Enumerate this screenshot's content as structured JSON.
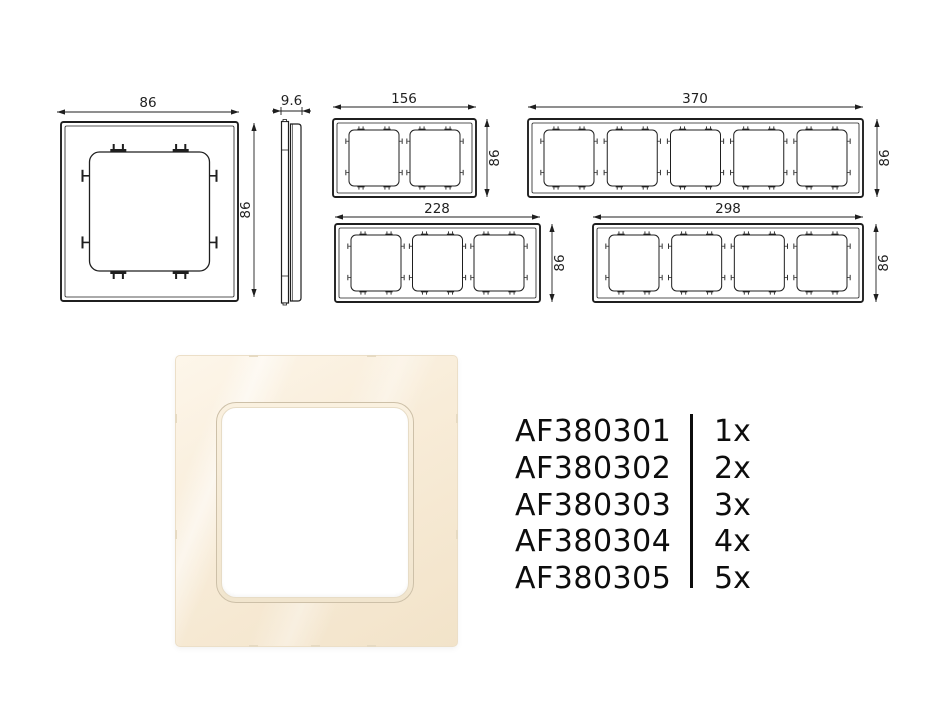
{
  "drawings": {
    "line_color": "#1f1f1f",
    "one_gang_front": {
      "width_label": "86",
      "height_label": "86"
    },
    "side_profile": {
      "depth_label": "9.6"
    },
    "two_gang": {
      "width_label": "156",
      "height_label": "86"
    },
    "five_gang": {
      "width_label": "370",
      "height_label": "86"
    },
    "three_gang": {
      "width_label": "228",
      "height_label": "86"
    },
    "four_gang": {
      "width_label": "298",
      "height_label": "86"
    }
  },
  "product_render": {
    "frame_color": "#f8ecd9",
    "opening_ring_color": "#cdc0a8",
    "opening_color": "#ffffff"
  },
  "products": [
    {
      "code": "AF380301",
      "qty": "1x"
    },
    {
      "code": "AF380302",
      "qty": "2x"
    },
    {
      "code": "AF380303",
      "qty": "3x"
    },
    {
      "code": "AF380304",
      "qty": "4x"
    },
    {
      "code": "AF380305",
      "qty": "5x"
    }
  ]
}
